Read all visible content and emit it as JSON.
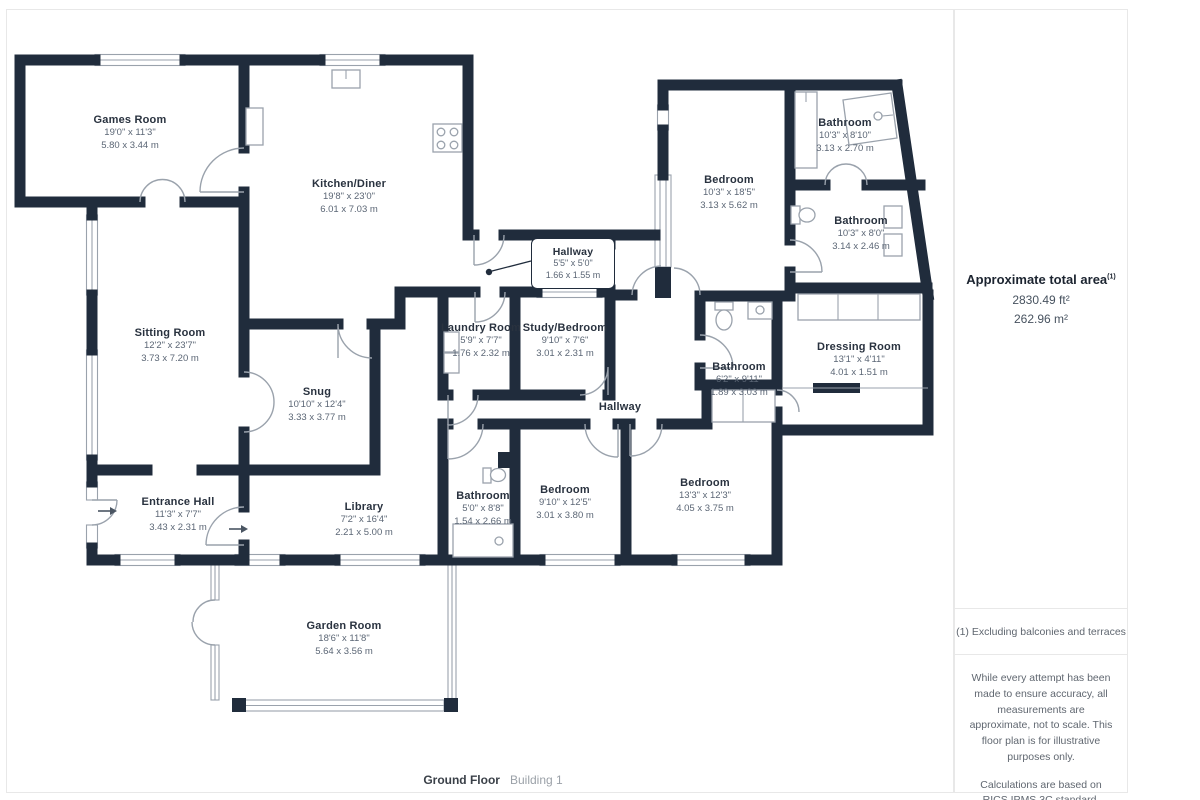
{
  "colors": {
    "wall": "#202c3c",
    "thin": "#9aa2ac",
    "label": "#29323f",
    "dims": "#5b6675"
  },
  "footer": {
    "floor_label": "Ground Floor",
    "building_label": "Building 1"
  },
  "sidebar": {
    "area": {
      "title": "Approximate total area",
      "superscript": "(1)",
      "imperial": "2830.49 ft²",
      "metric": "262.96 m²"
    },
    "note": "(1) Excluding balconies and terraces",
    "disclaimer_1": "While every attempt has been made to ensure accuracy, all measurements are approximate, not to scale. This floor plan is for illustrative purposes only.",
    "disclaimer_2": "Calculations are based on RICS IPMS 3C standard.",
    "brand": {
      "name": "GIRAFFE",
      "suffix": "360"
    }
  },
  "rooms": [
    {
      "name": "Games Room",
      "dims_imperial": "19'0\" x 11'3\"",
      "dims_metric": "5.80 x 3.44 m"
    },
    {
      "name": "Kitchen/Diner",
      "dims_imperial": "19'8\" x 23'0\"",
      "dims_metric": "6.01 x 7.03 m"
    },
    {
      "name": "Sitting Room",
      "dims_imperial": "12'2\" x 23'7\"",
      "dims_metric": "3.73 x 7.20 m"
    },
    {
      "name": "Snug",
      "dims_imperial": "10'10\" x 12'4\"",
      "dims_metric": "3.33 x 3.77 m"
    },
    {
      "name": "Hallway",
      "dims_imperial": "5'5\" x 5'0\"",
      "dims_metric": "1.66 x 1.55 m"
    },
    {
      "name": "Laundry Room",
      "dims_imperial": "5'9\" x 7'7\"",
      "dims_metric": "1.76 x 2.32 m"
    },
    {
      "name": "Study/Bedroom",
      "dims_imperial": "9'10\" x 7'6\"",
      "dims_metric": "3.01 x 2.31 m"
    },
    {
      "name": "Bedroom",
      "dims_imperial": "10'3\" x 18'5\"",
      "dims_metric": "3.13 x 5.62 m"
    },
    {
      "name": "Bathroom",
      "dims_imperial": "10'3\" x 8'10\"",
      "dims_metric": "3.13 x 2.70 m"
    },
    {
      "name": "Bathroom",
      "dims_imperial": "10'3\" x 8'0\"",
      "dims_metric": "3.14 x 2.46 m"
    },
    {
      "name": "Bathroom",
      "dims_imperial": "6'2\" x 9'11\"",
      "dims_metric": "1.89 x 3.03 m"
    },
    {
      "name": "Dressing Room",
      "dims_imperial": "13'1\" x 4'11\"",
      "dims_metric": "4.01 x 1.51 m"
    },
    {
      "name": "Hallway"
    },
    {
      "name": "Entrance Hall",
      "dims_imperial": "11'3\" x 7'7\"",
      "dims_metric": "3.43 x 2.31 m"
    },
    {
      "name": "Library",
      "dims_imperial": "7'2\" x 16'4\"",
      "dims_metric": "2.21 x 5.00 m"
    },
    {
      "name": "Bathroom",
      "dims_imperial": "5'0\" x 8'8\"",
      "dims_metric": "1.54 x 2.66 m"
    },
    {
      "name": "Bedroom",
      "dims_imperial": "9'10\" x 12'5\"",
      "dims_metric": "3.01 x 3.80 m"
    },
    {
      "name": "Bedroom",
      "dims_imperial": "13'3\" x 12'3\"",
      "dims_metric": "4.05 x 3.75 m"
    },
    {
      "name": "Garden Room",
      "dims_imperial": "18'6\" x 11'8\"",
      "dims_metric": "5.64 x 3.56 m"
    }
  ]
}
